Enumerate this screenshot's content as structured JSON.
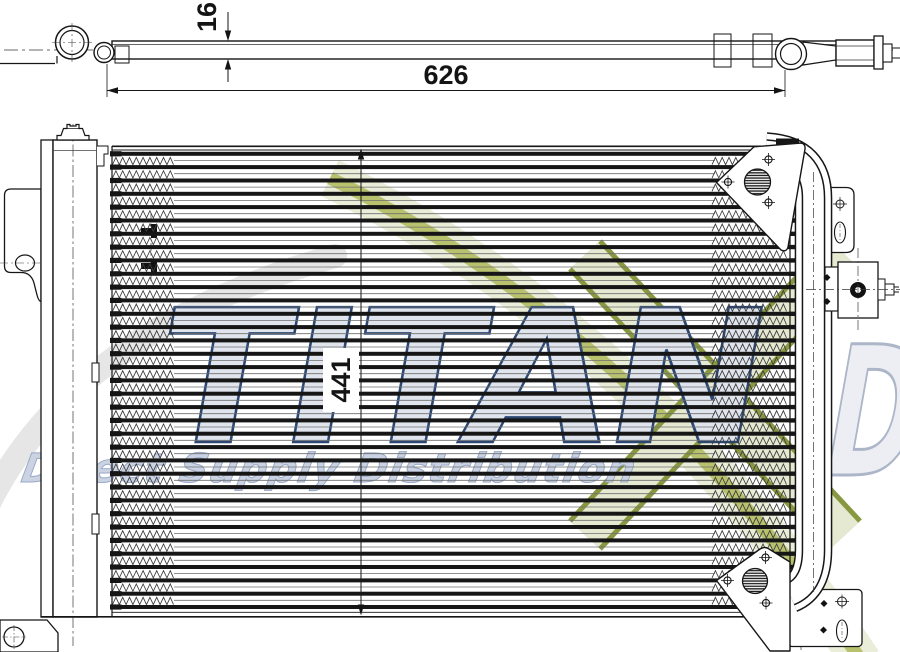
{
  "drawing": {
    "title": "condenser-technical-drawing",
    "dimensions": {
      "overall_width": "626",
      "profile_thickness": "16",
      "core_height": "441",
      "height_label_color": "#22365c"
    },
    "watermark": {
      "brand": "TITAN",
      "brand_partial_letters": "DS",
      "tagline": "Direct Supply Distribution",
      "colors": {
        "navy_outline": "#24406e",
        "letter_fill": "#dfe3ec",
        "partial_letter_fill": "#eceef3",
        "partial_letter_outline": "#a9b4c6",
        "olive": "#a9b44c",
        "olive_dark": "#84943a",
        "pale_olive": "#e5e9d0",
        "gray_swoosh": "#e2e2e2",
        "tagline_fill": "#c9d2e2",
        "tagline_outline": "#94a5c6"
      }
    },
    "line_color": "#161616"
  }
}
